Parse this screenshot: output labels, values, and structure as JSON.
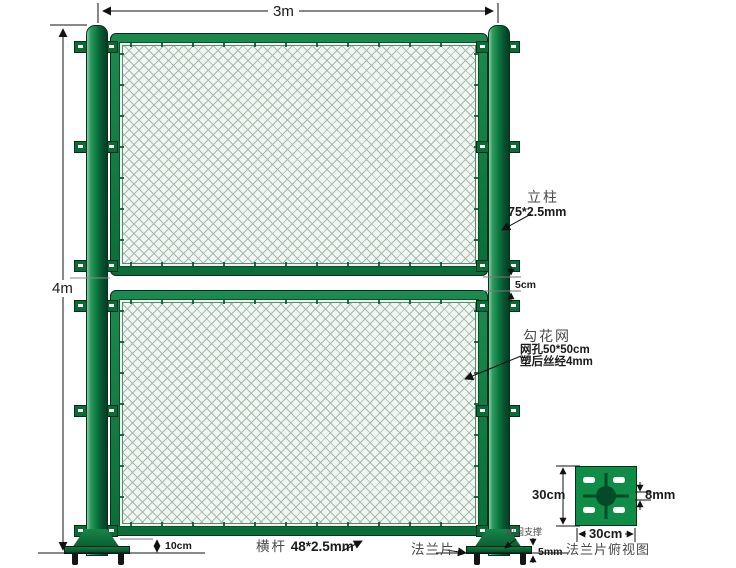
{
  "dimensions": {
    "overall_width": "3m",
    "overall_height": "4m",
    "panel_gap": "5cm",
    "bottom_clearance": "10cm",
    "plate_thickness": "5mm"
  },
  "labels": {
    "post": {
      "name": "立柱",
      "spec": "75*2.5mm"
    },
    "mesh": {
      "name": "勾花网",
      "spec_hole": "网孔50*50cm",
      "spec_wire": "塑后丝经4mm"
    },
    "rail": {
      "name": "横杆",
      "spec": "48*2.5mm"
    },
    "flange": {
      "name": "法兰片"
    },
    "brace": {
      "name": "加固支撑"
    }
  },
  "flange_detail": {
    "width": "30cm",
    "height": "30cm",
    "hole": "8mm",
    "caption": "法兰片俯视图"
  },
  "colors": {
    "frame_green": "#0d7d41",
    "post_dark": "#07492a",
    "mesh_line": "#a3bcab",
    "annotation_ink": "#1a1a1a"
  }
}
